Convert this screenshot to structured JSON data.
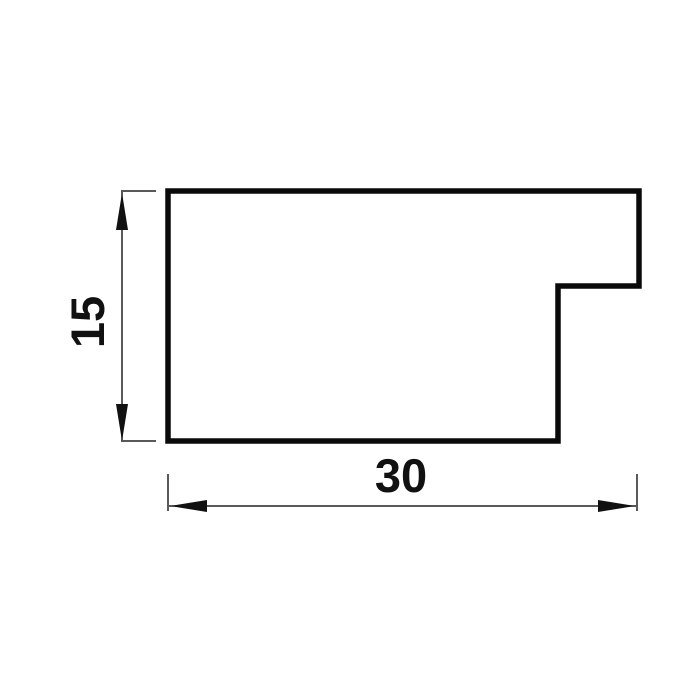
{
  "drawing": {
    "kind": "technical-drawing",
    "subject": "profile-cross-section",
    "background_color": "#ffffff",
    "outline_color": "#0a0a0a",
    "dimension_line_color": "#222222",
    "profile": {
      "shape": "rectangle-with-top-right-step-notch",
      "width_label": "30",
      "height_label": "15"
    }
  },
  "dimensions": {
    "height": {
      "label": "15",
      "orientation": "vertical",
      "label_rotation_deg": -90
    },
    "width": {
      "label": "30",
      "orientation": "horizontal",
      "label_rotation_deg": 0
    }
  }
}
